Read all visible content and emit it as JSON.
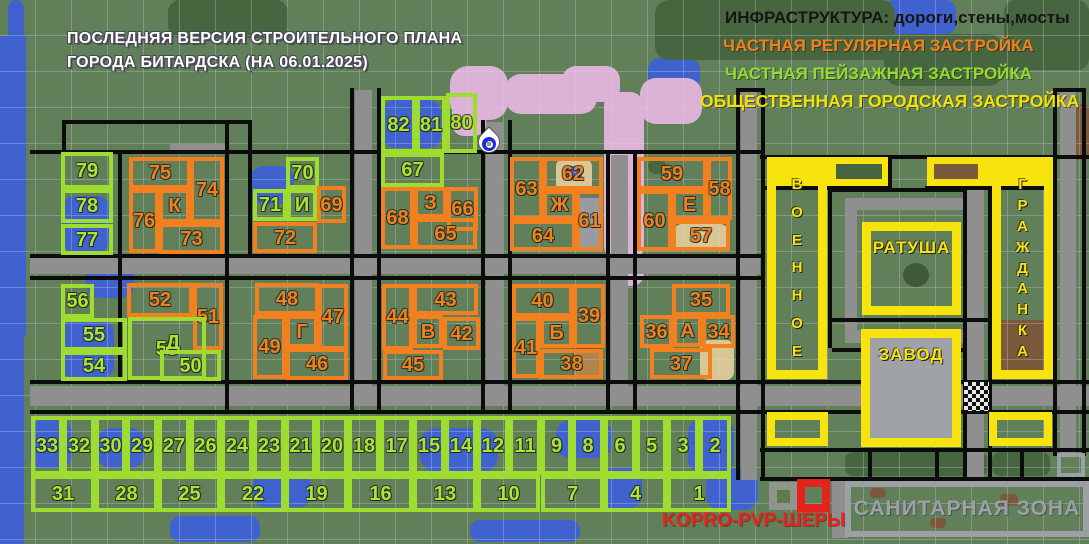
{
  "title": {
    "line1": "ПОСЛЕДНЯЯ ВЕРСИЯ СТРОИТЕЛЬНОГО ПЛАНА",
    "line2": "ГОРОДА БИТАРДСКА (НА 06.01.2025)"
  },
  "legend": {
    "infrastructure": "ИНФРАСТРУКТУРА: дороги,стены,мосты",
    "private_regular": "ЧАСТНАЯ РЕГУЛЯРНАЯ ЗАСТРОЙКА",
    "private_landscape": "ЧАСТНАЯ ПЕЙЗАЖНАЯ ЗАСТРОЙКА",
    "public_urban": "ОБЩЕСТВЕННАЯ ГОРОДСКАЯ ЗАСТРОЙКА"
  },
  "colors": {
    "orange": "#f2801e",
    "green": "#9edc2f",
    "yellow": "#f6e40c",
    "red": "#e3231c",
    "infra_text": "#161616",
    "sanitary_text": "#9ba1a7"
  },
  "zones": {
    "military": {
      "letters": [
        "В",
        "О",
        "Е",
        "Н",
        "Н",
        "О",
        "Е"
      ]
    },
    "townhall": {
      "label": "РАТУША"
    },
    "factory": {
      "label": "ЗАВОД"
    },
    "civilian": {
      "letters": [
        "Г",
        "Р",
        "А",
        "Ж",
        "Д",
        "А",
        "Н",
        "К",
        "А"
      ]
    },
    "sanitary": {
      "label": "САНИТАРНАЯ ЗОНА"
    }
  },
  "annotations": {
    "kopro": "KOPRO-PVP-ШЕРЫ"
  },
  "plots": {
    "fields": [
      "label",
      "type",
      "x",
      "y",
      "w",
      "h"
    ],
    "types": {
      "g": "green bordered plot",
      "o": "orange bordered plot",
      "t": "green label only"
    },
    "items": [
      [
        "79",
        "g",
        61,
        152,
        52,
        37
      ],
      [
        "78",
        "g",
        61,
        189,
        52,
        34
      ],
      [
        "77",
        "g",
        61,
        224,
        52,
        31
      ],
      [
        "75",
        "o",
        129,
        157,
        62,
        32
      ],
      [
        "74",
        "o",
        190,
        157,
        34,
        66
      ],
      [
        "76",
        "o",
        129,
        189,
        30,
        64
      ],
      [
        "К",
        "o",
        159,
        189,
        31,
        34
      ],
      [
        "73",
        "o",
        159,
        223,
        65,
        31
      ],
      [
        "70",
        "g",
        286,
        157,
        33,
        32
      ],
      [
        "71",
        "g",
        253,
        189,
        34,
        32
      ],
      [
        "И",
        "g",
        287,
        189,
        30,
        32
      ],
      [
        "69",
        "o",
        317,
        186,
        29,
        37
      ],
      [
        "72",
        "o",
        253,
        222,
        64,
        31
      ],
      [
        "82",
        "g",
        381,
        96,
        35,
        57
      ],
      [
        "81",
        "g",
        416,
        96,
        30,
        57
      ],
      [
        "80",
        "g",
        446,
        93,
        31,
        60
      ],
      [
        "67",
        "g",
        381,
        153,
        63,
        34
      ],
      [
        "68",
        "o",
        381,
        187,
        33,
        62
      ],
      [
        "З",
        "o",
        414,
        187,
        33,
        31
      ],
      [
        "66",
        "o",
        447,
        187,
        31,
        44
      ],
      [
        "65",
        "o",
        414,
        218,
        63,
        31
      ],
      [
        "62",
        "o",
        543,
        157,
        60,
        33
      ],
      [
        "63",
        "o",
        510,
        157,
        33,
        63
      ],
      [
        "Ж",
        "o",
        543,
        190,
        33,
        30
      ],
      [
        "61",
        "o",
        576,
        190,
        27,
        61
      ],
      [
        "64",
        "o",
        510,
        220,
        66,
        31
      ],
      [
        "59",
        "o",
        637,
        157,
        70,
        33
      ],
      [
        "58",
        "o",
        707,
        157,
        25,
        63
      ],
      [
        "60",
        "o",
        637,
        190,
        35,
        61
      ],
      [
        "Е",
        "o",
        672,
        190,
        35,
        30
      ],
      [
        "57",
        "o",
        672,
        220,
        58,
        31
      ],
      [
        "56",
        "g",
        61,
        284,
        33,
        34
      ],
      [
        "55",
        "g",
        61,
        318,
        66,
        33
      ],
      [
        "54",
        "g",
        61,
        351,
        66,
        30
      ],
      [
        "52",
        "o",
        127,
        283,
        66,
        34
      ],
      [
        "51",
        "o",
        193,
        283,
        30,
        67
      ],
      [
        "53",
        "g",
        128,
        317,
        78,
        63
      ],
      [
        "Д",
        "t",
        158,
        328,
        30,
        30
      ],
      [
        "50",
        "g",
        160,
        350,
        61,
        31
      ],
      [
        "48",
        "o",
        255,
        283,
        64,
        32
      ],
      [
        "47",
        "o",
        318,
        284,
        30,
        66
      ],
      [
        "49",
        "o",
        253,
        315,
        33,
        64
      ],
      [
        "Г",
        "o",
        286,
        315,
        32,
        33
      ],
      [
        "46",
        "o",
        286,
        348,
        62,
        32
      ],
      [
        "43",
        "o",
        413,
        284,
        65,
        31
      ],
      [
        "44",
        "o",
        382,
        284,
        31,
        66
      ],
      [
        "В",
        "o",
        413,
        315,
        30,
        33
      ],
      [
        "42",
        "o",
        443,
        317,
        37,
        33
      ],
      [
        "45",
        "o",
        383,
        350,
        60,
        30
      ],
      [
        "40",
        "o",
        512,
        284,
        61,
        33
      ],
      [
        "39",
        "o",
        573,
        284,
        32,
        64
      ],
      [
        "41",
        "o",
        512,
        317,
        28,
        61
      ],
      [
        "Б",
        "o",
        540,
        317,
        33,
        31
      ],
      [
        "38",
        "o",
        540,
        349,
        63,
        30
      ],
      [
        "35",
        "o",
        672,
        284,
        58,
        32
      ],
      [
        "34",
        "o",
        702,
        315,
        33,
        33
      ],
      [
        "36",
        "o",
        640,
        315,
        33,
        33
      ],
      [
        "А",
        "o",
        673,
        315,
        29,
        32
      ],
      [
        "37",
        "o",
        650,
        348,
        62,
        31
      ],
      [
        "33",
        "g",
        31,
        416,
        32,
        59
      ],
      [
        "32",
        "g",
        63,
        416,
        32,
        59
      ],
      [
        "30",
        "g",
        95,
        416,
        31,
        59
      ],
      [
        "29",
        "g",
        126,
        416,
        32,
        59
      ],
      [
        "27",
        "g",
        158,
        416,
        32,
        59
      ],
      [
        "26",
        "g",
        190,
        416,
        31,
        59
      ],
      [
        "24",
        "g",
        221,
        416,
        32,
        59
      ],
      [
        "23",
        "g",
        253,
        416,
        32,
        59
      ],
      [
        "21",
        "g",
        285,
        416,
        31,
        59
      ],
      [
        "20",
        "g",
        316,
        416,
        32,
        59
      ],
      [
        "18",
        "g",
        348,
        416,
        32,
        59
      ],
      [
        "17",
        "g",
        380,
        416,
        33,
        59
      ],
      [
        "15",
        "g",
        413,
        416,
        32,
        59
      ],
      [
        "14",
        "g",
        445,
        416,
        32,
        59
      ],
      [
        "12",
        "g",
        477,
        416,
        32,
        59
      ],
      [
        "11",
        "g",
        509,
        416,
        32,
        59
      ],
      [
        "9",
        "g",
        541,
        416,
        31,
        59
      ],
      [
        "8",
        "g",
        572,
        416,
        32,
        59
      ],
      [
        "6",
        "g",
        604,
        416,
        32,
        59
      ],
      [
        "5",
        "g",
        636,
        416,
        31,
        59
      ],
      [
        "3",
        "g",
        667,
        416,
        32,
        59
      ],
      [
        "2",
        "g",
        699,
        416,
        32,
        59
      ],
      [
        "31",
        "g",
        31,
        475,
        64,
        37
      ],
      [
        "28",
        "g",
        95,
        475,
        63,
        37
      ],
      [
        "25",
        "g",
        158,
        475,
        63,
        37
      ],
      [
        "22",
        "g",
        221,
        475,
        64,
        37
      ],
      [
        "19",
        "g",
        285,
        475,
        63,
        37
      ],
      [
        "16",
        "g",
        348,
        475,
        65,
        37
      ],
      [
        "13",
        "g",
        413,
        475,
        64,
        37
      ],
      [
        "10",
        "g",
        477,
        475,
        63,
        37
      ],
      [
        "7",
        "g",
        541,
        475,
        63,
        37
      ],
      [
        "4",
        "g",
        604,
        475,
        63,
        37
      ],
      [
        "1",
        "g",
        667,
        475,
        64,
        37
      ]
    ]
  }
}
